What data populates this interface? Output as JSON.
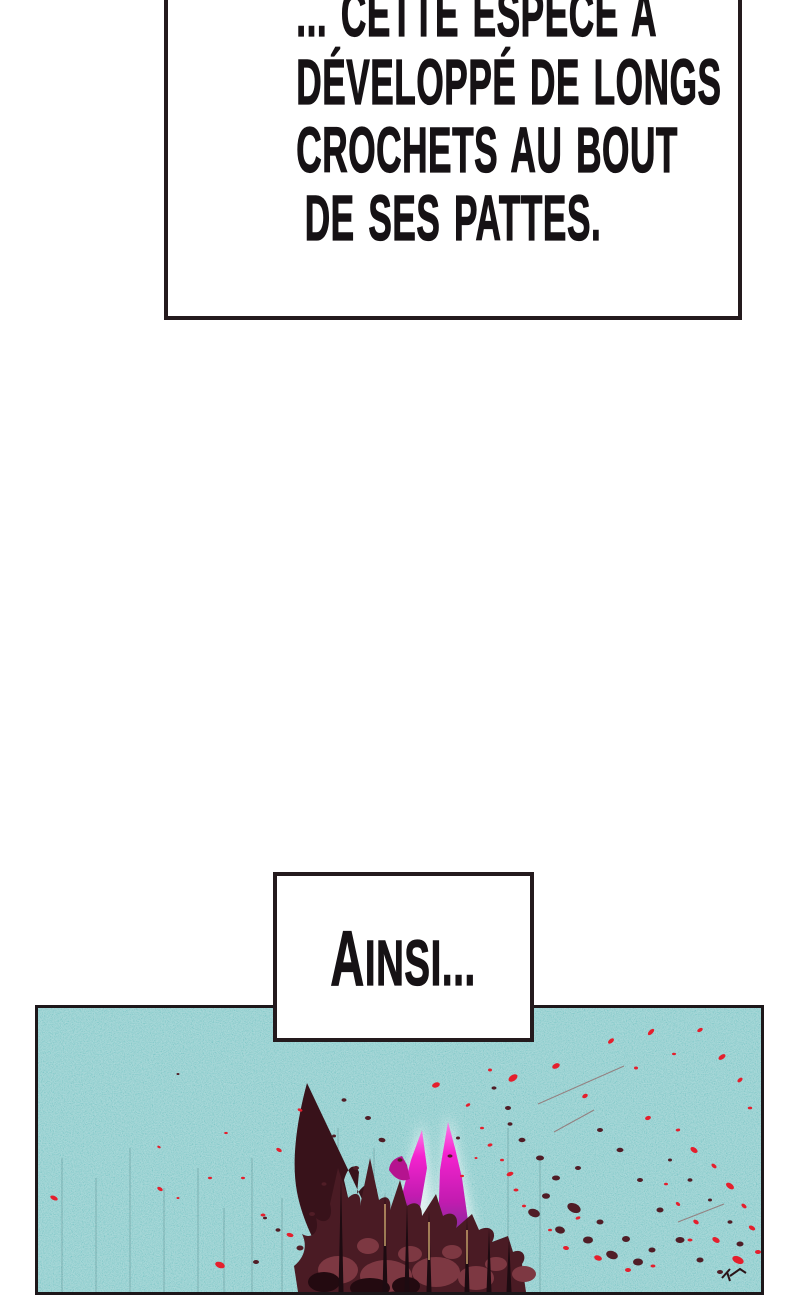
{
  "page_type": "webtoon-comic-page",
  "captions": {
    "top": {
      "lines": [
        "... CETTE ESPECE A",
        "DÉVELOPPÉ DE LONGS",
        "CROCHETS AU BOUT",
        "DE SES PATTES."
      ]
    },
    "ainsi": {
      "text": "AINSI..."
    }
  },
  "panel": {
    "colors": {
      "teal_base": "#6cc6c5",
      "teal_speckle_light": "#e8fbfa",
      "teal_speckle_dark": "#1a5a5e",
      "border": "#1d171a",
      "box_border": "#241a1d",
      "ink": "#161215",
      "blood_darkest": "#1d0b11",
      "blood_dark": "#38121a",
      "blood_mass": "#4a1b24",
      "blood_light": "#7d3842",
      "droplet_dark": "#501d26",
      "droplet_red": "#e41f2d",
      "spike_magenta": "#ea1ac6",
      "spike_purple": "#472a66",
      "needle_tan": "#c7a16b",
      "glow": "#ffffff"
    },
    "red_droplets": [
      [
        398,
        77,
        4,
        2.5,
        -20
      ],
      [
        430,
        97,
        2.5,
        1.5,
        -30
      ],
      [
        452,
        62,
        2,
        1.5,
        0
      ],
      [
        475,
        70,
        5,
        3,
        -35
      ],
      [
        518,
        58,
        4,
        2.5,
        -25
      ],
      [
        547,
        88,
        3,
        2,
        -30
      ],
      [
        573,
        33,
        3.5,
        2,
        -40
      ],
      [
        598,
        60,
        2,
        1.5,
        0
      ],
      [
        613,
        24,
        4,
        2,
        -45
      ],
      [
        636,
        46,
        2,
        1.2,
        0
      ],
      [
        662,
        22,
        3,
        1.8,
        -30
      ],
      [
        684,
        49,
        4,
        2.2,
        -35
      ],
      [
        702,
        72,
        3,
        1.8,
        -40
      ],
      [
        712,
        100,
        2.2,
        1.4,
        0
      ],
      [
        610,
        110,
        3,
        2,
        -20
      ],
      [
        640,
        122,
        2.2,
        1.4,
        -10
      ],
      [
        656,
        142,
        4,
        2.4,
        35
      ],
      [
        676,
        158,
        3,
        1.8,
        40
      ],
      [
        692,
        178,
        4.5,
        2.6,
        35
      ],
      [
        706,
        198,
        3,
        1.8,
        40
      ],
      [
        714,
        220,
        3.5,
        2,
        30
      ],
      [
        720,
        244,
        3,
        2,
        0
      ],
      [
        700,
        252,
        6,
        3.5,
        25
      ],
      [
        678,
        232,
        4,
        2.5,
        30
      ],
      [
        658,
        214,
        3,
        2,
        35
      ],
      [
        640,
        196,
        2.5,
        1.6,
        40
      ],
      [
        628,
        176,
        2,
        1.3,
        0
      ],
      [
        652,
        232,
        2.5,
        1.5,
        0
      ],
      [
        444,
        120,
        2,
        1.3,
        0
      ],
      [
        452,
        137,
        2.5,
        1.5,
        -15
      ],
      [
        464,
        152,
        2,
        1.3,
        0
      ],
      [
        472,
        166,
        3.5,
        2,
        -20
      ],
      [
        478,
        182,
        2.5,
        1.5,
        0
      ],
      [
        486,
        198,
        2,
        1.4,
        0
      ],
      [
        438,
        150,
        1.5,
        1,
        0
      ],
      [
        424,
        168,
        2,
        1.2,
        0
      ],
      [
        262,
        102,
        2.5,
        1.5,
        20
      ],
      [
        241,
        142,
        3,
        1.8,
        30
      ],
      [
        225,
        207,
        2.5,
        1.5,
        0
      ],
      [
        252,
        227,
        3.5,
        2,
        15
      ],
      [
        205,
        170,
        2,
        1.2,
        0
      ],
      [
        188,
        125,
        1.8,
        1.1,
        0
      ],
      [
        16,
        190,
        4,
        2,
        25
      ],
      [
        122,
        181,
        3,
        1.7,
        30
      ],
      [
        140,
        190,
        1.5,
        1,
        0
      ],
      [
        121,
        139,
        1.8,
        1.1,
        25
      ],
      [
        172,
        170,
        2,
        1.2,
        0
      ],
      [
        182,
        257,
        5,
        3,
        20
      ],
      [
        560,
        250,
        4,
        2.5,
        20
      ],
      [
        590,
        262,
        3,
        2,
        0
      ],
      [
        615,
        258,
        2.5,
        1.5,
        0
      ],
      [
        528,
        240,
        3,
        2,
        10
      ],
      [
        512,
        222,
        2,
        1.3,
        0
      ],
      [
        540,
        210,
        2.5,
        1.5,
        -20
      ]
    ],
    "dark_droplets": [
      [
        470,
        100,
        3,
        2,
        0
      ],
      [
        456,
        80,
        2.5,
        1.6,
        0
      ],
      [
        496,
        205,
        6,
        4,
        20
      ],
      [
        508,
        188,
        4,
        2.8,
        0
      ],
      [
        522,
        222,
        5,
        3.5,
        15
      ],
      [
        536,
        200,
        7,
        4.5,
        25
      ],
      [
        550,
        232,
        5,
        3.5,
        0
      ],
      [
        562,
        214,
        3.5,
        2.5,
        0
      ],
      [
        574,
        247,
        6,
        4,
        20
      ],
      [
        588,
        231,
        4,
        3,
        0
      ],
      [
        600,
        254,
        5,
        3.5,
        0
      ],
      [
        614,
        242,
        3.5,
        2.5,
        0
      ],
      [
        518,
        170,
        4,
        2.5,
        0
      ],
      [
        540,
        160,
        3,
        2,
        0
      ],
      [
        502,
        150,
        4,
        2.5,
        0
      ],
      [
        484,
        132,
        3.5,
        2.2,
        0
      ],
      [
        472,
        116,
        2.5,
        1.8,
        0
      ],
      [
        562,
        122,
        3,
        2,
        0
      ],
      [
        582,
        142,
        3.5,
        2.2,
        0
      ],
      [
        602,
        172,
        3,
        2,
        0
      ],
      [
        622,
        202,
        3.5,
        2.5,
        0
      ],
      [
        642,
        232,
        4.5,
        3,
        0
      ],
      [
        662,
        252,
        3.5,
        2.5,
        0
      ],
      [
        682,
        264,
        3,
        2,
        0
      ],
      [
        632,
        152,
        2,
        1.5,
        0
      ],
      [
        652,
        172,
        2.5,
        1.8,
        0
      ],
      [
        672,
        192,
        2,
        1.5,
        0
      ],
      [
        692,
        214,
        2.5,
        1.8,
        0
      ],
      [
        702,
        236,
        3.5,
        2.5,
        0
      ],
      [
        330,
        110,
        3,
        2,
        0
      ],
      [
        306,
        92,
        2.5,
        1.8,
        0
      ],
      [
        344,
        132,
        3.5,
        2.2,
        10
      ],
      [
        362,
        152,
        2.5,
        1.8,
        0
      ],
      [
        296,
        128,
        2,
        1.5,
        0
      ],
      [
        318,
        160,
        3,
        2,
        0
      ],
      [
        286,
        176,
        2.5,
        1.8,
        0
      ],
      [
        274,
        206,
        3,
        2,
        0
      ],
      [
        262,
        240,
        3.5,
        2.5,
        0
      ],
      [
        240,
        222,
        2.5,
        1.8,
        0
      ],
      [
        218,
        254,
        3,
        2,
        0
      ],
      [
        420,
        130,
        2,
        1.5,
        0
      ],
      [
        412,
        148,
        2.5,
        1.6,
        0
      ],
      [
        227,
        210,
        2,
        1.4,
        0
      ],
      [
        140,
        66,
        1.5,
        1,
        0
      ]
    ],
    "streaks": [
      [
        24,
        150
      ],
      [
        58,
        170
      ],
      [
        92,
        140
      ],
      [
        126,
        180
      ],
      [
        160,
        160
      ],
      [
        186,
        200
      ],
      [
        214,
        150
      ],
      [
        244,
        190
      ],
      [
        300,
        120
      ],
      [
        336,
        140
      ],
      [
        470,
        120
      ],
      [
        502,
        150
      ]
    ],
    "hairlines": [
      [
        500,
        96,
        586,
        58
      ],
      [
        516,
        124,
        556,
        102
      ],
      [
        640,
        214,
        686,
        196
      ]
    ]
  }
}
